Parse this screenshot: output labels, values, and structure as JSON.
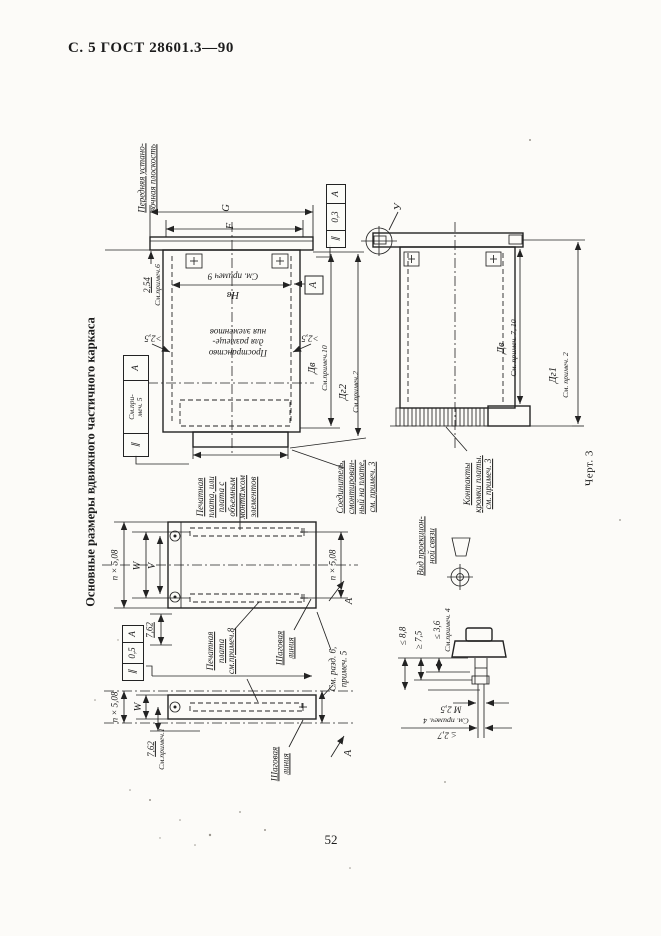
{
  "page": {
    "header": "С. 5 ГОСТ 28601.3—90",
    "side_title": "Основные размеры вдвижного частичного каркаса",
    "figure_caption": "Черт. 3",
    "page_number": "52"
  },
  "d1": {
    "front_plane": "Передняя устано-\nвочная плоскость",
    "dim_g": "G",
    "dim_f": "F",
    "dim_254": "2,54",
    "note_254": "См.примеч.6",
    "hb_note": "См. примеч 9",
    "hb": "Нв",
    "gap": ">2,5",
    "space": "Пространство\nдля размеще-\nния элементов",
    "tol_top": {
      "sym": "∥",
      "val": "0,3",
      "datum": "А"
    },
    "tol_left": {
      "sym": "∥",
      "val": "См.при-\nмеч. 5",
      "datum": "А"
    },
    "datum_flag": "А",
    "db": "Дв",
    "db_note": "См.примеч.10",
    "dg2": "Дг2",
    "dg2_note": "См.примеч.2",
    "pcb": "Печатная\nплата, или\nплата с\nобъемным\nмонтажом\nэлементов",
    "connector": "Соединитель,\nсмонтирован-\nный на плате,\nсм. примеч. 3"
  },
  "d2": {
    "view_u": "У",
    "db": "Дв",
    "db_note": "См. примеч. 7, 10",
    "dg1": "Дг1",
    "dg1_note": "См. примеч. 2",
    "contacts": "Контакты\nкромки платы.\nсм. примеч. 3"
  },
  "d3": {
    "pitch_left": "n × 5,08",
    "w": "W",
    "v": "V",
    "pitch_right": "n × 5,08",
    "dim_762": "7,62",
    "tol": {
      "sym": "∥",
      "val": "0,5",
      "datum": "А"
    },
    "pcb_note": "Печатная\nплата\nсм.примеч.8",
    "pitch_line": "Шаговая\nлиния",
    "see_sect": "См. разд. 6,\nпримеч. 5",
    "datum_a": "А"
  },
  "d4": {
    "w": "W",
    "pitch": "n × 5,08",
    "dim_762": "7,62",
    "note_762": "См.примеч.1",
    "pitch_line": "Шаговая\nлиния",
    "datum_a": "А"
  },
  "detail": {
    "proj_view": "Вид проекцион-\nной связи",
    "d88": "≤ 8,8",
    "d75": "≥ 7,5",
    "d36": "≤ 3,6",
    "d36_note": "См.примеч. 4",
    "m25": "М 2,5",
    "d27": "≤ 2,7",
    "d27_note": "См. примеч. 4"
  }
}
